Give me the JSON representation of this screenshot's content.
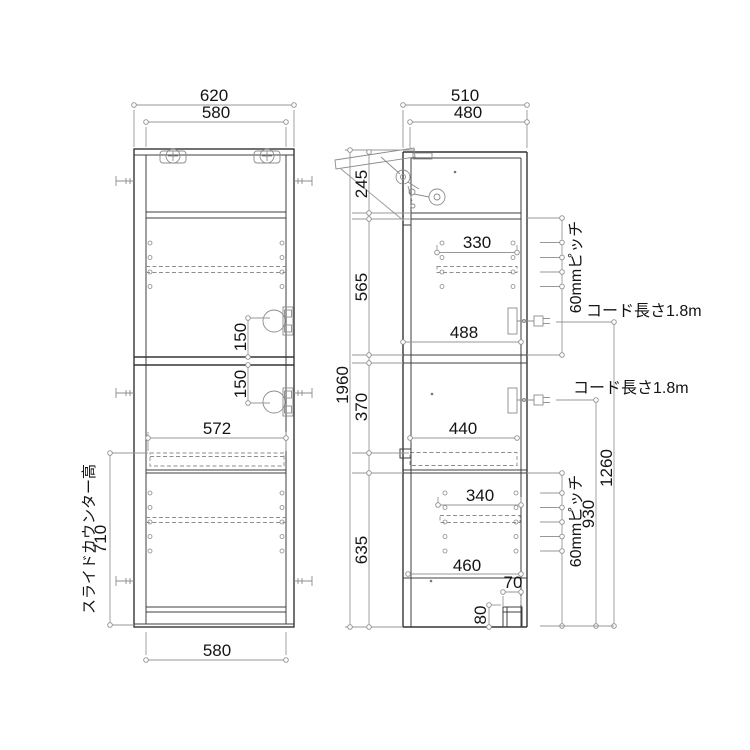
{
  "colors": {
    "line": "#3f3f3f",
    "dimension": "#979797",
    "text": "#141414",
    "background": "#ffffff"
  },
  "left_view": {
    "dims": {
      "top_width_outer": "620",
      "top_width_inner": "580",
      "outlet_upper_gap": "150",
      "outlet_lower_gap": "150",
      "counter_width": "572",
      "counter_height_label": "スライドカウンター高",
      "counter_height_value": "710",
      "bottom_width": "580"
    }
  },
  "right_view": {
    "dims": {
      "top_depth_outer": "510",
      "top_depth_inner": "480",
      "flap_section_height": "245",
      "upper_section_height": "565",
      "middle_section_height": "370",
      "lower_section_height": "635",
      "total_height": "1960",
      "upper_shelf_span": "330",
      "upper_interior_depth": "488",
      "counter_depth": "440",
      "lower_shelf_span": "340",
      "lower_interior_depth": "460",
      "base_inset": "70",
      "base_height": "80",
      "pitch_upper": "60mmピッチ",
      "pitch_lower": "60mmピッチ",
      "cord_upper": "コード長さ1.8m",
      "cord_lower": "コード長さ1.8m",
      "upper_outlet_height": "1260",
      "lower_outlet_height": "930"
    }
  }
}
